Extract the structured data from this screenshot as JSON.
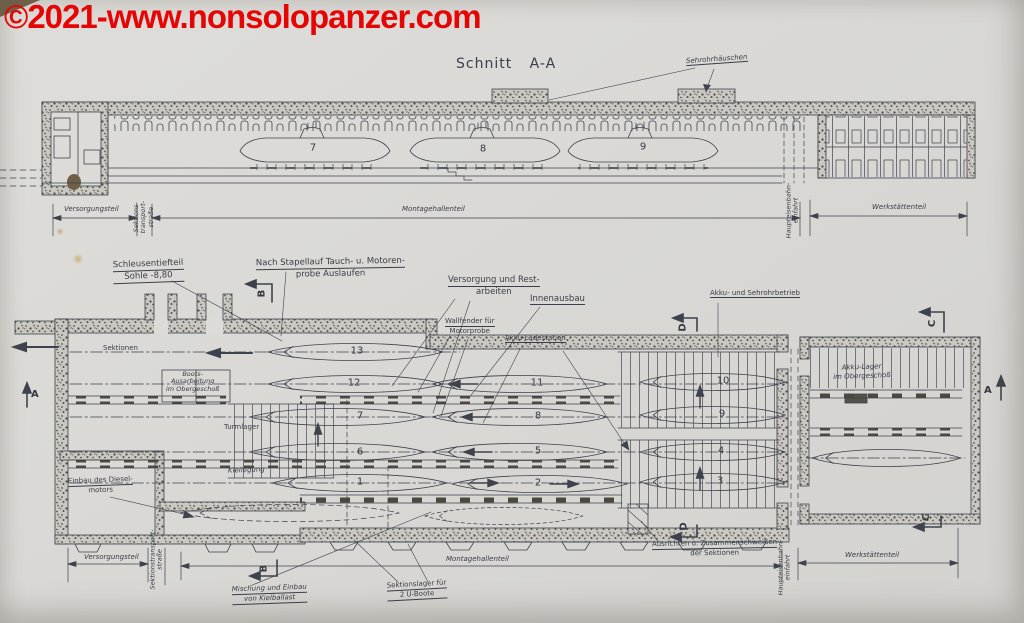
{
  "watermark": {
    "text": "©2021-www.nonsolopanzer.com",
    "color": "#e60505"
  },
  "colors": {
    "ink": "#3e424c",
    "paper": "#dad9d5",
    "watermark_red": "#e60505"
  },
  "section_view": {
    "title": "Schnitt A-A",
    "roof_callout": "Sehrohrhäuschen",
    "boat_numbers": [
      "7",
      "8",
      "9"
    ],
    "dimensions": {
      "versorgungsteil": "Versorgungsteil",
      "sektionstransportstrasse": [
        "Sektions-",
        "transport-",
        "straße"
      ],
      "montagehallenteil": "Montagehallenteil",
      "haupteisenbahneinfahrt": [
        "Haupteisenbahn-",
        "einfahrt"
      ],
      "werkstaettenteil": "Werkstättenteil"
    }
  },
  "plan_view": {
    "callouts": {
      "schleusentiefteil": [
        "Schleusentiefteil",
        "Sohle -8,80"
      ],
      "nach_stapellauf": [
        "Nach Stapellauf Tauch- u. Motoren-",
        "probe Auslaufen"
      ],
      "versorgung_restarbeiten": [
        "Versorgung und Rest-",
        "arbeiten"
      ],
      "innenausbau": "Innenausbau",
      "wallfender": [
        "Wallfender für",
        "Motorprobe"
      ],
      "akku_ladestation": "Akku-Ladestation",
      "akku_sehrohrbetrieb": "Akku- und Sehrohrbetrieb",
      "akku_lager": [
        "Akku-Lager",
        "im Obergeschoß"
      ],
      "sektionen": "Sektionen",
      "boots_ausarbeitung": [
        "Boots-",
        "Ausarbeitung",
        "im Obergeschoß"
      ],
      "turmlager": "Turmlager",
      "kiellegung": "Kiellegung",
      "einbau_dieselmotors": [
        "Einbau des Diesel-",
        "motors"
      ],
      "mischung_kielballast": [
        "Mischung und Einbau",
        "von Kielballast"
      ],
      "sektionslager": [
        "Sektionslager für",
        "2 U-Boote"
      ],
      "ausrichten": [
        "Ausrichten u. Zusammenschweißen",
        "der Sektionen"
      ]
    },
    "dimensions": {
      "versorgungsteil": "Versorgungsteil",
      "sektionstransportstrasse": [
        "Sektionstransport-",
        "straße"
      ],
      "montagehallenteil": "Montagehallenteil",
      "haupteisenbahneinfahrt": [
        "Haupteisenbahn-",
        "einfahrt"
      ],
      "werkstaettenteil": "Werkstättenteil"
    },
    "berth_numbers": [
      "13",
      "12",
      "11",
      "10",
      "7",
      "8",
      "9",
      "6",
      "5",
      "4",
      "1",
      "2",
      "3"
    ],
    "section_markers": {
      "a": "A",
      "b": "B",
      "c": "C",
      "d": "D"
    }
  }
}
